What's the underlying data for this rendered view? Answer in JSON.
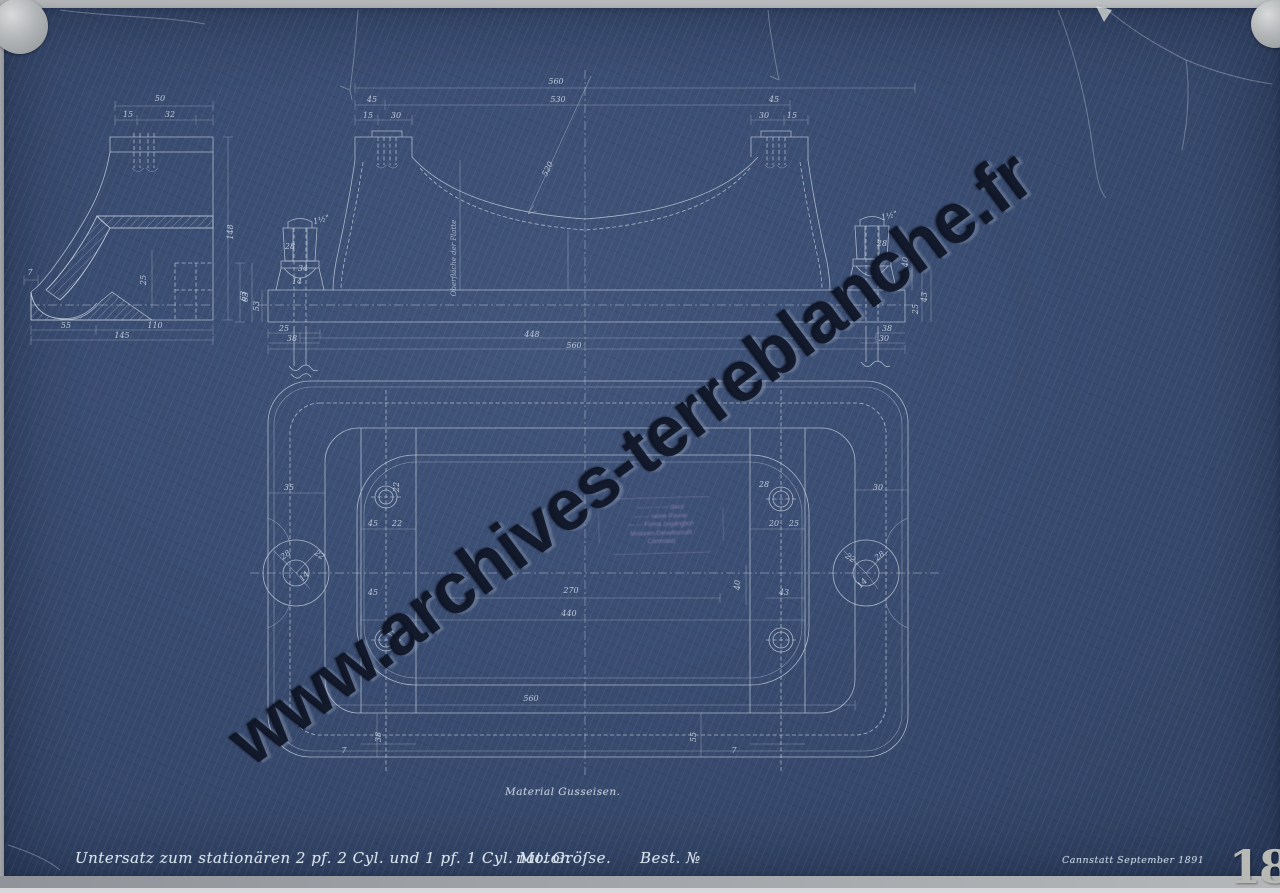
{
  "sheet": {
    "type": "blueprint technical drawing",
    "page_number": "18"
  },
  "captions": {
    "title": "Untersatz zum stationären 2 pf. 2 Cyl. und 1 pf. 1 Cyl. Motor.",
    "scale": "nat. Gröſse.",
    "order": "Best. №",
    "material": "Material Gusseisen.",
    "place_date": "Cannstatt September 1891",
    "axis_note": "Oberfläche der Platte"
  },
  "watermark": {
    "text": "www.archives-terreblanche.fr"
  },
  "stamp": {
    "lines": [
      "— — — — dass",
      "— — seine Pause",
      "— — Firma zugänglich",
      "Motoren-Gesellschaft",
      "Cannstatt"
    ]
  },
  "colors": {
    "sheet_blue": "#3a4d72",
    "line_white": "#c6d2de",
    "backing_gray": "#b5b8ba",
    "watermark_ink": "#0d1426",
    "page_number_gray": "#b7bab4"
  },
  "dimensions": [
    {
      "t": "50",
      "x": 160,
      "y": 101
    },
    {
      "t": "15",
      "x": 128,
      "y": 117
    },
    {
      "t": "32",
      "x": 170,
      "y": 117
    },
    {
      "t": "148",
      "x": 233,
      "y": 232,
      "rot": -90
    },
    {
      "t": "63",
      "x": 246,
      "y": 296,
      "rot": -90
    },
    {
      "t": "25",
      "x": 146,
      "y": 280,
      "rot": -90
    },
    {
      "t": "7",
      "x": 30,
      "y": 275
    },
    {
      "t": "55",
      "x": 66,
      "y": 328
    },
    {
      "t": "110",
      "x": 155,
      "y": 328
    },
    {
      "t": "145",
      "x": 122,
      "y": 338
    },
    {
      "t": "560",
      "x": 556,
      "y": 84
    },
    {
      "t": "530",
      "x": 558,
      "y": 102
    },
    {
      "t": "45",
      "x": 372,
      "y": 102
    },
    {
      "t": "45",
      "x": 774,
      "y": 102
    },
    {
      "t": "15",
      "x": 368,
      "y": 118
    },
    {
      "t": "30",
      "x": 396,
      "y": 118
    },
    {
      "t": "30",
      "x": 764,
      "y": 118
    },
    {
      "t": "15",
      "x": 792,
      "y": 118
    },
    {
      "t": "520",
      "x": 550,
      "y": 170,
      "rot": -64
    },
    {
      "t": "1½\"",
      "x": 322,
      "y": 222,
      "rot": -15
    },
    {
      "t": "1½\"",
      "x": 890,
      "y": 218,
      "rot": -15
    },
    {
      "t": "28",
      "x": 290,
      "y": 249
    },
    {
      "t": "28",
      "x": 882,
      "y": 246
    },
    {
      "t": "34",
      "x": 303,
      "y": 271
    },
    {
      "t": "14",
      "x": 297,
      "y": 284
    },
    {
      "t": "63",
      "x": 248,
      "y": 297,
      "rot": -90
    },
    {
      "t": "53",
      "x": 259,
      "y": 306,
      "rot": -90
    },
    {
      "t": "25",
      "x": 284,
      "y": 331
    },
    {
      "t": "38",
      "x": 292,
      "y": 341
    },
    {
      "t": "448",
      "x": 532,
      "y": 337
    },
    {
      "t": "560",
      "x": 574,
      "y": 348
    },
    {
      "t": "43",
      "x": 927,
      "y": 297,
      "rot": -90
    },
    {
      "t": "25",
      "x": 918,
      "y": 309,
      "rot": -90
    },
    {
      "t": "40",
      "x": 908,
      "y": 262,
      "rot": -90
    },
    {
      "t": "38",
      "x": 887,
      "y": 331
    },
    {
      "t": "30",
      "x": 884,
      "y": 341
    },
    {
      "t": "35",
      "x": 289,
      "y": 490
    },
    {
      "t": "28",
      "x": 287,
      "y": 557,
      "rot": -35
    },
    {
      "t": "22",
      "x": 318,
      "y": 557,
      "rot": 35
    },
    {
      "t": "14",
      "x": 306,
      "y": 578,
      "rot": -45
    },
    {
      "t": "22",
      "x": 399,
      "y": 487,
      "rot": -90
    },
    {
      "t": "45",
      "x": 373,
      "y": 526
    },
    {
      "t": "22",
      "x": 397,
      "y": 526
    },
    {
      "t": "45",
      "x": 373,
      "y": 595
    },
    {
      "t": "28",
      "x": 764,
      "y": 487
    },
    {
      "t": "30",
      "x": 878,
      "y": 490
    },
    {
      "t": "20",
      "x": 774,
      "y": 526
    },
    {
      "t": "25",
      "x": 794,
      "y": 526
    },
    {
      "t": "40",
      "x": 740,
      "y": 585,
      "rot": -90
    },
    {
      "t": "43",
      "x": 784,
      "y": 595
    },
    {
      "t": "28",
      "x": 881,
      "y": 558,
      "rot": -35
    },
    {
      "t": "22",
      "x": 849,
      "y": 560,
      "rot": 35
    },
    {
      "t": "14",
      "x": 864,
      "y": 585,
      "rot": -45
    },
    {
      "t": "270",
      "x": 571,
      "y": 593
    },
    {
      "t": "440",
      "x": 569,
      "y": 616
    },
    {
      "t": "560",
      "x": 531,
      "y": 701
    },
    {
      "t": "38",
      "x": 381,
      "y": 737,
      "rot": -90
    },
    {
      "t": "55",
      "x": 696,
      "y": 737,
      "rot": -90
    },
    {
      "t": "7",
      "x": 344,
      "y": 753
    },
    {
      "t": "7",
      "x": 734,
      "y": 753
    }
  ]
}
